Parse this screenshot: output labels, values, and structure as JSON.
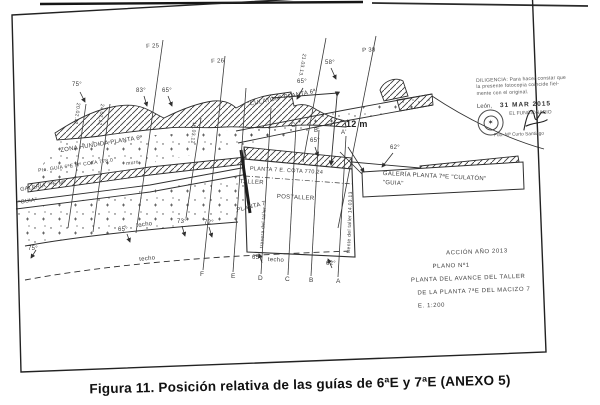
{
  "figure": {
    "caption": "Figura 11. Posición relativa de las guías de 6ªE y 7ªE (ANEXO 5)"
  },
  "stamp": {
    "line1": "DILIGENCIA: Para hacer constar que",
    "line2": "la presente fotocopia coincide fiel-",
    "line3": "mente con el original.",
    "place": "León,",
    "date": "31 MAR 2015",
    "official": "EL FUNCIONARIO",
    "signed": "Fdo. Mª Curto Santiago",
    "seal_icon": "✶"
  },
  "title_block": {
    "lines": [
      "ACCIÓN AÑO 2013",
      "PLANO Nº1",
      "PLANTA DEL AVANCE DEL TALLER",
      "DE LA PLANTA 7ªE DEL MACIZO 7",
      "E. 1:200"
    ]
  },
  "diagram": {
    "dimension": "12 m",
    "labels": [
      {
        "t": "F 25",
        "x": 146,
        "y": 44,
        "r": -3,
        "s": 6,
        "n": "fault-label-f25"
      },
      {
        "t": "F 26",
        "x": 211,
        "y": 59,
        "r": -3,
        "s": 6,
        "n": "fault-label-f26"
      },
      {
        "t": "P 38",
        "x": 362,
        "y": 48,
        "r": -3,
        "s": 6,
        "n": "fault-label-p38"
      },
      {
        "t": "21.03.13.",
        "x": 306,
        "y": 54,
        "r": 100,
        "s": 5,
        "n": "fault-date"
      },
      {
        "t": "75°",
        "x": 72,
        "y": 82,
        "r": 0,
        "s": 6,
        "n": "dip-angle"
      },
      {
        "t": "83°",
        "x": 136,
        "y": 88,
        "r": 0,
        "s": 6,
        "n": "dip-angle"
      },
      {
        "t": "65°",
        "x": 162,
        "y": 88,
        "r": 0,
        "s": 6,
        "n": "dip-angle"
      },
      {
        "t": "65°",
        "x": 297,
        "y": 79,
        "r": 0,
        "s": 6,
        "n": "dip-angle"
      },
      {
        "t": "58°",
        "x": 325,
        "y": 60,
        "r": 0,
        "s": 6,
        "n": "dip-angle"
      },
      {
        "t": "62°",
        "x": 390,
        "y": 145,
        "r": 0,
        "s": 6,
        "n": "dip-angle"
      },
      {
        "t": "65°",
        "x": 310,
        "y": 138,
        "r": 0,
        "s": 6,
        "n": "dip-angle"
      },
      {
        "t": "ZONA HUNDIDA PLANTA 6ª",
        "x": 60,
        "y": 148,
        "r": -9,
        "s": 6,
        "n": "zona-hundida-label"
      },
      {
        "t": "Pte. GUÍA 6ªE Mº COTA 778.0",
        "x": 38,
        "y": 169,
        "r": -8,
        "s": 5,
        "n": "guia-6e-label"
      },
      {
        "t": "muro",
        "x": 126,
        "y": 162,
        "r": -8,
        "s": 5,
        "n": "muro-label"
      },
      {
        "t": "GALERÍA 7ªE Mº",
        "x": 20,
        "y": 188,
        "r": -9,
        "s": 5.5,
        "n": "galeria-7e-label"
      },
      {
        "t": "\"GUIA\"",
        "x": 18,
        "y": 201,
        "r": -9,
        "s": 5.5,
        "n": "guia-label"
      },
      {
        "t": "\"CULATÓN\" PLANTA 6ª",
        "x": 247,
        "y": 102,
        "r": -11,
        "s": 6,
        "n": "culaton-6a-label"
      },
      {
        "t": "PLANTA 7 E. COTA 770.24",
        "x": 250,
        "y": 167,
        "r": 3,
        "s": 5.5,
        "n": "planta7-cota-label"
      },
      {
        "t": "TALLER",
        "x": 240,
        "y": 179,
        "r": 3,
        "s": 6,
        "n": "taller-label"
      },
      {
        "t": "POSTALLER",
        "x": 277,
        "y": 194,
        "r": 3,
        "s": 6,
        "n": "postaller-label"
      },
      {
        "t": "PLANTA 7",
        "x": 236,
        "y": 208,
        "r": -14,
        "s": 6,
        "n": "planta7-label"
      },
      {
        "t": "trasera del taller",
        "x": 260,
        "y": 248,
        "r": -86,
        "s": 5,
        "n": "trasera-taller-label"
      },
      {
        "t": "frente del taller 14.03.13",
        "x": 347,
        "y": 253,
        "r": -88,
        "s": 5,
        "n": "frente-taller-label"
      },
      {
        "t": "GALERÍA PLANTA 7ªE \"CULATÓN\"",
        "x": 383,
        "y": 171,
        "r": 3,
        "s": 6,
        "n": "galeria-planta7e-label"
      },
      {
        "t": "\"GUIA\"",
        "x": 383,
        "y": 180,
        "r": 3,
        "s": 6,
        "n": "guia-label"
      },
      {
        "t": "12 m",
        "x": 346,
        "y": 120,
        "r": 0,
        "s": 9,
        "b": 1,
        "n": "distance-12m-label"
      },
      {
        "t": "techo",
        "x": 136,
        "y": 223,
        "r": -7,
        "s": 6,
        "n": "techo-label"
      },
      {
        "t": "65°",
        "x": 118,
        "y": 227,
        "r": 0,
        "s": 6,
        "n": "dip-angle"
      },
      {
        "t": "techo",
        "x": 139,
        "y": 257,
        "r": -6,
        "s": 6,
        "n": "techo-label"
      },
      {
        "t": "techo",
        "x": 268,
        "y": 257,
        "r": 3,
        "s": 6,
        "n": "techo-label"
      },
      {
        "t": "65°",
        "x": 252,
        "y": 255,
        "r": 0,
        "s": 6,
        "n": "dip-angle"
      },
      {
        "t": "62°",
        "x": 326,
        "y": 261,
        "r": 0,
        "s": 6,
        "n": "dip-angle"
      },
      {
        "t": "73°",
        "x": 177,
        "y": 219,
        "r": 0,
        "s": 6,
        "n": "dip-angle"
      },
      {
        "t": "72°",
        "x": 204,
        "y": 220,
        "r": 0,
        "s": 6,
        "n": "dip-angle"
      },
      {
        "t": "75°",
        "x": 28,
        "y": 246,
        "r": 0,
        "s": 6,
        "n": "dip-angle"
      },
      {
        "t": "20.02.12",
        "x": 80,
        "y": 103,
        "r": 97,
        "s": 5,
        "n": "fault-date"
      },
      {
        "t": "24.02.12",
        "x": 104,
        "y": 104,
        "r": 97,
        "s": 5,
        "n": "fault-date"
      },
      {
        "t": "16.03.12",
        "x": 196,
        "y": 122,
        "r": 95,
        "s": 5,
        "n": "fault-date"
      },
      {
        "t": "F",
        "x": 200,
        "y": 272,
        "r": 0,
        "s": 6.5,
        "n": "section-letter"
      },
      {
        "t": "E",
        "x": 231,
        "y": 274,
        "r": 0,
        "s": 6.5,
        "n": "section-letter"
      },
      {
        "t": "D",
        "x": 258,
        "y": 276,
        "r": 0,
        "s": 6.5,
        "n": "section-letter"
      },
      {
        "t": "C",
        "x": 285,
        "y": 277,
        "r": 0,
        "s": 6.5,
        "n": "section-letter"
      },
      {
        "t": "B",
        "x": 309,
        "y": 278,
        "r": 0,
        "s": 6.5,
        "n": "section-letter"
      },
      {
        "t": "A",
        "x": 336,
        "y": 279,
        "r": 0,
        "s": 6.5,
        "n": "section-letter"
      },
      {
        "t": "C'",
        "x": 291,
        "y": 123,
        "r": 0,
        "s": 6,
        "n": "section-letter"
      },
      {
        "t": "B'",
        "x": 314,
        "y": 128,
        "r": 0,
        "s": 6,
        "n": "section-letter"
      },
      {
        "t": "A'",
        "x": 341,
        "y": 130,
        "r": 0,
        "s": 6,
        "n": "section-letter"
      }
    ]
  }
}
